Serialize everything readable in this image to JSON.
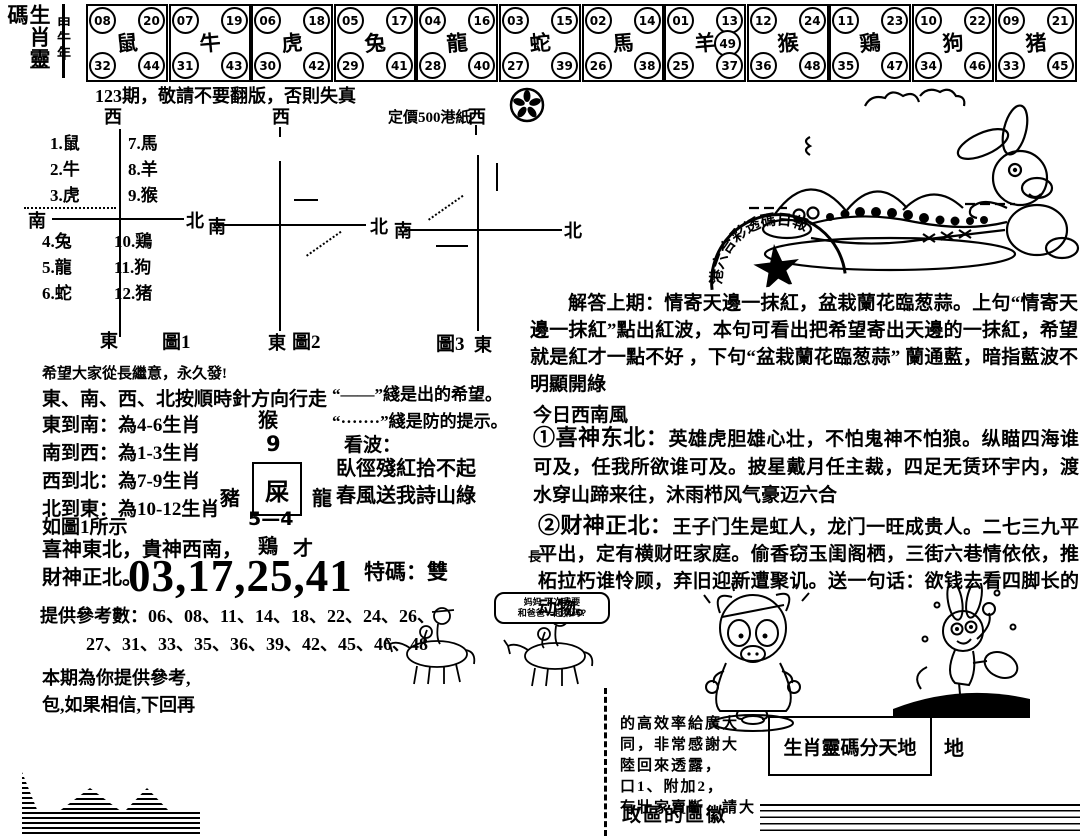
{
  "masthead": {
    "title": "生肖靈碼",
    "year": "甲午年"
  },
  "zodiac_boxes": [
    {
      "name": "rat",
      "animal": "鼠",
      "tl": "08",
      "tr": "20",
      "bl": "32",
      "br": "44"
    },
    {
      "name": "ox",
      "animal": "牛",
      "tl": "07",
      "tr": "19",
      "bl": "31",
      "br": "43"
    },
    {
      "name": "tiger",
      "animal": "虎",
      "tl": "06",
      "tr": "18",
      "bl": "30",
      "br": "42"
    },
    {
      "name": "rabbit",
      "animal": "兔",
      "tl": "05",
      "tr": "17",
      "bl": "29",
      "br": "41"
    },
    {
      "name": "dragon",
      "animal": "龍",
      "tl": "04",
      "tr": "16",
      "bl": "28",
      "br": "40"
    },
    {
      "name": "snake",
      "animal": "蛇",
      "tl": "03",
      "tr": "15",
      "bl": "27",
      "br": "39"
    },
    {
      "name": "horse",
      "animal": "馬",
      "tl": "02",
      "tr": "14",
      "bl": "26",
      "br": "38"
    },
    {
      "name": "goat",
      "animal": "羊",
      "tl": "01",
      "tr": "13",
      "extra": "49",
      "bl": "25",
      "br": "37"
    },
    {
      "name": "monkey",
      "animal": "猴",
      "tl": "12",
      "tr": "24",
      "bl": "36",
      "br": "48"
    },
    {
      "name": "rooster",
      "animal": "鶏",
      "tl": "11",
      "tr": "23",
      "bl": "35",
      "br": "47"
    },
    {
      "name": "dog",
      "animal": "狗",
      "tl": "10",
      "tr": "22",
      "bl": "34",
      "br": "46"
    },
    {
      "name": "pig",
      "animal": "猪",
      "tl": "09",
      "tr": "21",
      "bl": "33",
      "br": "45"
    }
  ],
  "notice": "123期，敬請不要翻版，否則失真",
  "price": "定價500港紙",
  "compass": {
    "west": "西",
    "south": "南",
    "north": "北",
    "east": "東"
  },
  "figures": {
    "fig1": {
      "label": "圖1",
      "nw": [
        "1.鼠",
        "2.牛",
        "3.虎"
      ],
      "ne": [
        "7.馬",
        "8.羊",
        "9.猴"
      ],
      "sw": [
        "4.兔",
        "5.龍",
        "6.蛇"
      ],
      "se": [
        "10.鶏",
        "11.狗",
        "12.猪"
      ]
    },
    "fig2": {
      "label": "圖2"
    },
    "fig3": {
      "label": "圖3"
    }
  },
  "reading": {
    "hope": "希望大家從長繼意，永久發!",
    "walk": "東、南、西、北按順時針方向行走",
    "routes": [
      "東到南：為4-6生肖",
      "南到西：為1-3生肖",
      "西到北：為7-9生肖",
      "北到東：為10-12生肖"
    ],
    "as_fig": "如圖1所示",
    "gods_line1": "喜神東北，貴神西南，",
    "gods_line2": "財神正北。",
    "center": {
      "top": "猴",
      "num": "9",
      "left": "豬",
      "boxed": "屎",
      "right": "龍",
      "below": "5—4",
      "bottom_left": "鶏",
      "bottom_right": "才"
    }
  },
  "legend": {
    "solid": "“——”綫是出的希望。",
    "dotted": "“·······”綫是防的提示。",
    "kanbo": "看波：",
    "poem1": "臥徑殘紅拾不起",
    "poem2": "春風送我詩山綠"
  },
  "prediction": {
    "main_numbers": "03,17,25,41",
    "special": "特碼：雙",
    "ref_line1": "提供參考數：06、08、11、14、18、22、24、26、",
    "ref_line2": "27、31、33、35、36、39、42、45、46、48"
  },
  "footer_left": {
    "line1": "本期為你提供參考,",
    "line2": "包,如果相信,下回再"
  },
  "cartoons": {
    "bubble_line1": "妈妈,下次我要",
    "bubble_line2": "和爸爸一起猜码?",
    "stamp_text": "港六合彩透碼日報"
  },
  "right_column": {
    "answer": "解答上期：情寄天邊一抹紅，盆栽蘭花臨葱蒜。上句“情寄天邊一抹紅”點出紅波，本句可看出把希望寄出天邊的一抹紅，希望就是紅才一點不好 ，下句“盆栽蘭花臨葱蒜” 蘭通藍，暗指藍波不明顯開綠",
    "wind": "今日西南風",
    "item1_label": "①喜神东北：",
    "item1_text": "英雄虎胆雄心壮，不怕鬼神不怕狼。纵瞄四海谁可及，任我所欲谁可及。披星戴月任主裁，四足无赁环宇内，渡水穿山蹄来往，沐雨栉风气豪迈六合",
    "item2_label": "②财神正北：",
    "item2_text": "王子门生是虹人，龙门一旺成贵人。二七三九平平出，定有横财旺家庭。偷香窃玉闺阁栖，三街六巷情依依，推柘拉朽谁怜顾，弃旧迎新遭聚讥。送一句话：欲钱去看四脚长的动物。",
    "margin_char": "長"
  },
  "bottom_right": {
    "snippets": [
      "的高效率給廣大",
      "同，非常感謝大",
      "陸回來透露，",
      "口1、附加2，",
      "有壯家賣斷，請大"
    ],
    "emblem": "政區的區徽",
    "box_title": "生肖靈碼分天地",
    "side_char": "地"
  }
}
